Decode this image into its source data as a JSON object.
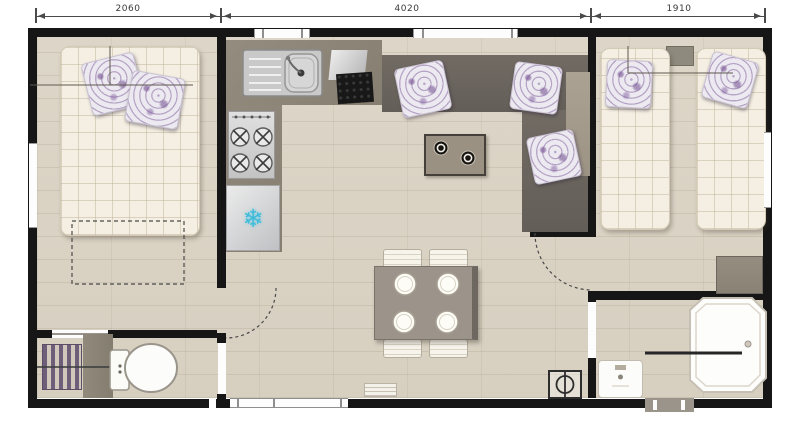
{
  "plan": {
    "type": "mobile-home-floorplan",
    "dimension_labels": [
      "2060",
      "4020",
      "1910"
    ],
    "icons": {
      "freezer_glyph": "❄"
    },
    "colors": {
      "wall": "#161616",
      "floor": "#d9d1c2",
      "counter": "#8c8476",
      "sofa": "#6b655f",
      "mattress": "#f4efe2",
      "pillow_pattern": "#7a5b8f",
      "snowflake": "#3fbcd9",
      "table": "#9c948a",
      "fixture_white": "#fdfdfd",
      "radiator": "#6f5e79"
    }
  }
}
